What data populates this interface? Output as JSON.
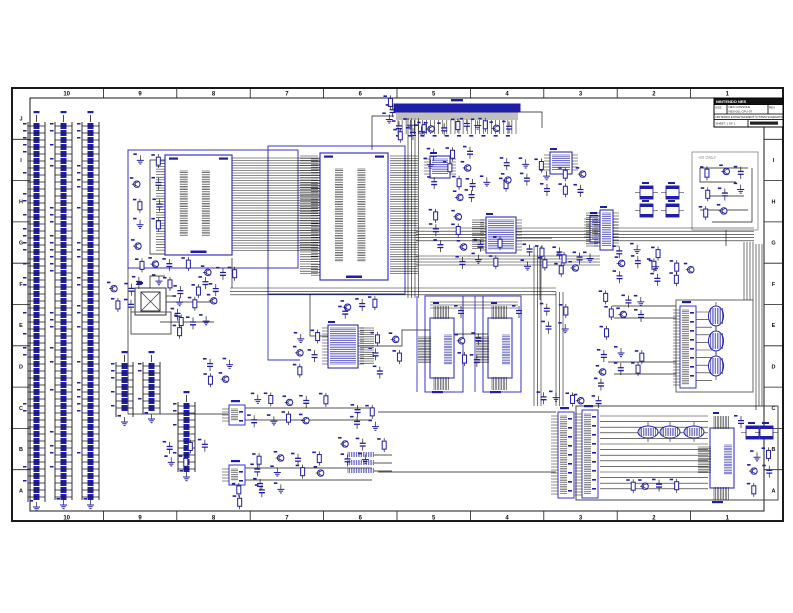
{
  "colors": {
    "frame": "#1a1a1a",
    "wire": "#1a1a1a",
    "navy": "#1e1ea8",
    "blue": "#3535c8",
    "graybox": "#999999",
    "graytext": "#909090",
    "sheet_bg": "#ffffff",
    "titlebar_bg": "#111111"
  },
  "sheet": {
    "frame": {
      "outer": [
        12,
        88,
        783,
        521
      ],
      "inner": [
        30,
        98,
        764,
        511
      ]
    },
    "zones": {
      "columns": [
        "10",
        "9",
        "8",
        "7",
        "6",
        "5",
        "4",
        "3",
        "2",
        "1"
      ],
      "rows": [
        "J",
        "I",
        "H",
        "G",
        "F",
        "E",
        "D",
        "C",
        "B",
        "A"
      ]
    },
    "title_block": {
      "company": "NINTENDO NES",
      "doc_line1": "NES CONSOLE",
      "doc_line2": "NES-001 CPU-07",
      "size_label": "SIZE",
      "rev_label": "REV",
      "footer": "NINTENDO ENTERTAINMENT SYSTEM SCHEMATIC",
      "sheet_label": "SHEET 1 OF 1"
    },
    "notes": [
      {
        "text": "-60 ONLY",
        "x": 698,
        "y": 159
      }
    ]
  },
  "schematic": {
    "ladders": [
      {
        "x": 28,
        "y": 122,
        "h": 380
      },
      {
        "x": 55,
        "y": 122,
        "h": 378
      },
      {
        "x": 82,
        "y": 122,
        "h": 378
      },
      {
        "x": 116,
        "y": 362,
        "h": 55
      },
      {
        "x": 143,
        "y": 362,
        "h": 52
      },
      {
        "x": 178,
        "y": 402,
        "h": 70
      }
    ],
    "blueboxes": [
      {
        "x": 128,
        "y": 150,
        "w": 170,
        "h": 118
      },
      {
        "x": 268,
        "y": 146,
        "w": 137,
        "h": 148
      },
      {
        "x": 425,
        "y": 296,
        "w": 38,
        "h": 96
      },
      {
        "x": 483,
        "y": 296,
        "w": 38,
        "h": 96
      }
    ],
    "grayboxes": [
      {
        "x": 676,
        "y": 300,
        "w": 77,
        "h": 92,
        "c": "#666666"
      },
      {
        "x": 576,
        "y": 406,
        "w": 202,
        "h": 94,
        "c": "#444444"
      },
      {
        "x": 692,
        "y": 152,
        "w": 66,
        "h": 78,
        "c": "#999999"
      },
      {
        "x": 135,
        "y": 288,
        "w": 31,
        "h": 27,
        "c": "#333333"
      },
      {
        "x": 141,
        "y": 292,
        "w": 19,
        "h": 19,
        "c": "#333333"
      },
      {
        "x": 131,
        "y": 312,
        "w": 40,
        "h": 22,
        "c": "#555555"
      }
    ],
    "ics": [
      {
        "id": "cpu",
        "x": 165,
        "y": 155,
        "w": 67,
        "h": 100
      },
      {
        "id": "ppu",
        "x": 320,
        "y": 153,
        "w": 68,
        "h": 127
      }
    ],
    "small_ics": [
      {
        "x": 430,
        "y": 156,
        "w": 20,
        "h": 22
      },
      {
        "x": 550,
        "y": 152,
        "w": 22,
        "h": 22
      },
      {
        "x": 590,
        "y": 216,
        "w": 22,
        "h": 26
      },
      {
        "x": 486,
        "y": 217,
        "w": 30,
        "h": 36,
        "hl": true
      },
      {
        "x": 328,
        "y": 325,
        "w": 30,
        "h": 43,
        "hr": true
      },
      {
        "x": 600,
        "y": 210,
        "w": 13,
        "h": 40,
        "hl": true
      }
    ],
    "rams": [
      {
        "x": 430,
        "y": 318
      },
      {
        "x": 488,
        "y": 318
      },
      {
        "x": 710,
        "y": 428
      }
    ],
    "conn_h": [
      {
        "x": 394,
        "y": 104,
        "w": 126,
        "pins": 30
      }
    ],
    "conn_v": [
      {
        "x": 558,
        "y": 412,
        "h": 86
      },
      {
        "x": 582,
        "y": 410,
        "h": 88
      },
      {
        "x": 680,
        "y": 306,
        "h": 82
      },
      {
        "x": 229,
        "y": 405,
        "h": 20
      },
      {
        "x": 229,
        "y": 465,
        "h": 20
      }
    ],
    "filters": [
      {
        "x": 640,
        "y": 186
      },
      {
        "x": 666,
        "y": 186
      },
      {
        "x": 640,
        "y": 204
      },
      {
        "x": 666,
        "y": 204
      },
      {
        "x": 746,
        "y": 426
      },
      {
        "x": 760,
        "y": 426
      }
    ],
    "ovals_v": [
      {
        "x": 716,
        "y": 316
      },
      {
        "x": 716,
        "y": 341
      },
      {
        "x": 716,
        "y": 366
      }
    ],
    "ovals_h": [
      {
        "x": 648,
        "y": 432
      },
      {
        "x": 670,
        "y": 432
      },
      {
        "x": 694,
        "y": 432
      }
    ],
    "hatch_trio": [
      {
        "x": 348,
        "y": 452
      },
      {
        "x": 348,
        "y": 460
      },
      {
        "x": 348,
        "y": 468
      }
    ],
    "clusters": [
      {
        "x": 384,
        "y": 96,
        "w": 16,
        "h": 26,
        "n": 3
      },
      {
        "x": 396,
        "y": 124,
        "w": 118,
        "h": 13,
        "n": 14
      },
      {
        "x": 128,
        "y": 152,
        "w": 38,
        "h": 104,
        "n": 9
      },
      {
        "x": 132,
        "y": 256,
        "w": 64,
        "h": 34,
        "n": 7
      },
      {
        "x": 200,
        "y": 268,
        "w": 40,
        "h": 22,
        "n": 4
      },
      {
        "x": 424,
        "y": 146,
        "w": 56,
        "h": 42,
        "n": 7
      },
      {
        "x": 452,
        "y": 176,
        "w": 60,
        "h": 28,
        "n": 6
      },
      {
        "x": 500,
        "y": 160,
        "w": 48,
        "h": 26,
        "n": 5
      },
      {
        "x": 540,
        "y": 168,
        "w": 52,
        "h": 30,
        "n": 6
      },
      {
        "x": 430,
        "y": 210,
        "w": 34,
        "h": 44,
        "n": 5
      },
      {
        "x": 452,
        "y": 238,
        "w": 56,
        "h": 30,
        "n": 6
      },
      {
        "x": 520,
        "y": 244,
        "w": 48,
        "h": 28,
        "n": 5
      },
      {
        "x": 556,
        "y": 250,
        "w": 44,
        "h": 26,
        "n": 5
      },
      {
        "x": 610,
        "y": 246,
        "w": 56,
        "h": 36,
        "n": 7
      },
      {
        "x": 648,
        "y": 262,
        "w": 52,
        "h": 26,
        "n": 5
      },
      {
        "x": 700,
        "y": 162,
        "w": 52,
        "h": 60,
        "n": 8
      },
      {
        "x": 108,
        "y": 282,
        "w": 34,
        "h": 30,
        "n": 4
      },
      {
        "x": 168,
        "y": 284,
        "w": 58,
        "h": 36,
        "n": 7
      },
      {
        "x": 172,
        "y": 316,
        "w": 44,
        "h": 22,
        "n": 4
      },
      {
        "x": 200,
        "y": 360,
        "w": 36,
        "h": 28,
        "n": 4
      },
      {
        "x": 292,
        "y": 330,
        "w": 34,
        "h": 48,
        "n": 5
      },
      {
        "x": 368,
        "y": 332,
        "w": 40,
        "h": 48,
        "n": 5
      },
      {
        "x": 456,
        "y": 328,
        "w": 28,
        "h": 44,
        "n": 4
      },
      {
        "x": 540,
        "y": 300,
        "w": 36,
        "h": 40,
        "n": 4
      },
      {
        "x": 600,
        "y": 292,
        "w": 52,
        "h": 46,
        "n": 7
      },
      {
        "x": 592,
        "y": 348,
        "w": 58,
        "h": 44,
        "n": 7
      },
      {
        "x": 248,
        "y": 392,
        "w": 84,
        "h": 36,
        "n": 9
      },
      {
        "x": 248,
        "y": 452,
        "w": 84,
        "h": 40,
        "n": 9
      },
      {
        "x": 336,
        "y": 436,
        "w": 56,
        "h": 34,
        "n": 5
      },
      {
        "x": 162,
        "y": 436,
        "w": 52,
        "h": 38,
        "n": 5
      },
      {
        "x": 230,
        "y": 484,
        "w": 64,
        "h": 22,
        "n": 4
      },
      {
        "x": 540,
        "y": 394,
        "w": 62,
        "h": 12,
        "n": 5
      },
      {
        "x": 748,
        "y": 448,
        "w": 26,
        "h": 48,
        "n": 5
      },
      {
        "x": 624,
        "y": 478,
        "w": 60,
        "h": 18,
        "n": 4
      },
      {
        "x": 340,
        "y": 300,
        "w": 40,
        "h": 20,
        "n": 4
      },
      {
        "x": 350,
        "y": 404,
        "w": 30,
        "h": 28,
        "n": 4
      }
    ],
    "bands": [
      {
        "x": 232,
        "y": 158,
        "len": 88,
        "n": 38,
        "sp": 2.5,
        "vert": false
      },
      {
        "x": 416,
        "y": 228,
        "len": 338,
        "n": 5,
        "sp": 3.2,
        "vert": false
      },
      {
        "x": 416,
        "y": 256,
        "len": 184,
        "n": 4,
        "sp": 3.0,
        "vert": false
      },
      {
        "x": 230,
        "y": 288,
        "len": 326,
        "n": 3,
        "sp": 3.4,
        "vert": false
      },
      {
        "x": 430,
        "y": 302,
        "len": 88,
        "n": 3,
        "sp": 3.0,
        "vert": false
      },
      {
        "x": 600,
        "y": 416,
        "len": 108,
        "n": 14,
        "sp": 5.6,
        "vert": false
      },
      {
        "x": 694,
        "y": 312,
        "len": 18,
        "n": 10,
        "sp": 7.6,
        "vert": false
      },
      {
        "x": 408,
        "y": 118,
        "len": 180,
        "n": 4,
        "sp": 3.5,
        "vert": true
      },
      {
        "x": 534,
        "y": 246,
        "len": 160,
        "n": 3,
        "sp": 3.5,
        "vert": true
      },
      {
        "x": 556,
        "y": 292,
        "len": 114,
        "n": 3,
        "sp": 3.5,
        "vert": true
      },
      {
        "x": 744,
        "y": 242,
        "len": 58,
        "n": 4,
        "sp": 3.0,
        "vert": true
      },
      {
        "x": 756,
        "y": 244,
        "len": 162,
        "n": 3,
        "sp": 3.0,
        "vert": true
      }
    ],
    "wires": [
      [
        394,
        116,
        372,
        116,
        372,
        150
      ],
      [
        520,
        112,
        542,
        112,
        542,
        128
      ],
      [
        165,
        160,
        150,
        160,
        150,
        254,
        165,
        254
      ],
      [
        128,
        268,
        128,
        414,
        228,
        414
      ],
      [
        232,
        258,
        232,
        288
      ],
      [
        166,
        302,
        214,
        302
      ],
      [
        160,
        322,
        214,
        322
      ],
      [
        310,
        294,
        310,
        336,
        328,
        336
      ],
      [
        358,
        346,
        402,
        346,
        402,
        330,
        430,
        330
      ],
      [
        454,
        334,
        488,
        334
      ],
      [
        516,
        238,
        552,
        238
      ],
      [
        245,
        408,
        372,
        408
      ],
      [
        245,
        420,
        372,
        420
      ],
      [
        245,
        468,
        372,
        468
      ],
      [
        245,
        480,
        372,
        480
      ],
      [
        378,
        412,
        556,
        412
      ],
      [
        378,
        472,
        556,
        472
      ],
      [
        612,
        306,
        676,
        306
      ],
      [
        614,
        318,
        676,
        318
      ],
      [
        608,
        362,
        676,
        362
      ],
      [
        614,
        374,
        676,
        374
      ],
      [
        726,
        230,
        726,
        246
      ],
      [
        700,
        168,
        748,
        168
      ],
      [
        700,
        168,
        700,
        182,
        736,
        182
      ],
      [
        708,
        196,
        744,
        196
      ],
      [
        700,
        210,
        748,
        210
      ],
      [
        712,
        222,
        752,
        222,
        752,
        168
      ],
      [
        166,
        296,
        176,
        296
      ],
      [
        150,
        288,
        150,
        276,
        165,
        276
      ],
      [
        374,
        455,
        392,
        455
      ],
      [
        374,
        463,
        392,
        463
      ],
      [
        374,
        471,
        392,
        471
      ],
      [
        756,
        406,
        756,
        410
      ],
      [
        540,
        254,
        540,
        300
      ]
    ],
    "bluelines": [
      [
        417,
        296,
        417,
        392
      ],
      [
        475,
        296,
        475,
        392
      ],
      [
        425,
        296,
        520,
        296
      ],
      [
        268,
        294,
        268,
        360,
        300,
        360
      ]
    ]
  }
}
